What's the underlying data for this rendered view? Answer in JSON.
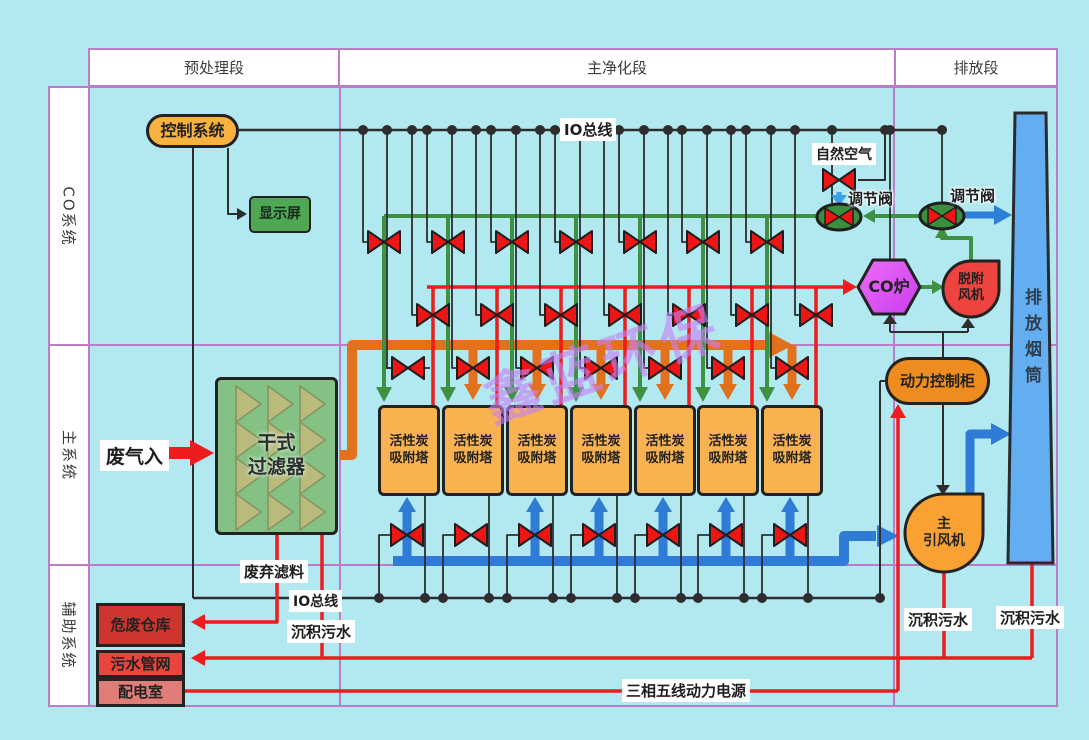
{
  "headers": {
    "pretreatment": "预处理段",
    "main_purification": "主净化段",
    "emission": "排放段"
  },
  "row_labels": {
    "co_system": "CO系统",
    "main_system": "主系统",
    "aux_system": "辅助系统"
  },
  "nodes": {
    "control_system": "控制系统",
    "display_screen": "显示屏",
    "dry_filter_line1": "干式",
    "dry_filter_line2": "过滤器",
    "tower_line1": "活性炭",
    "tower_line2": "吸附塔",
    "tower_count": 7,
    "co_furnace": "CO炉",
    "desorption_fan_line1": "脱附",
    "desorption_fan_line2": "风机",
    "power_cabinet": "动力控制柜",
    "main_fan_line1": "主",
    "main_fan_line2": "引风机",
    "stack": "排放烟筒",
    "hazardous_waste_warehouse": "危废仓库",
    "sewage_pipe_network": "污水管网",
    "power_distribution_room": "配电室"
  },
  "labels": {
    "io_bus_top": "IO总线",
    "io_bus_bottom": "IO总线",
    "natural_air": "自然空气",
    "regulating_valve_left": "调节阀",
    "regulating_valve_right": "调节阀",
    "waste_gas_in": "废气入",
    "waste_filter_material": "废弃滤料",
    "sediment_sewage_left": "沉积污水",
    "sediment_sewage_mid": "沉积污水",
    "sediment_sewage_right": "沉积污水",
    "power_supply_line": "三相五线动力电源",
    "watermark": "鑫蓝环保"
  },
  "colors": {
    "background": "#b2e8f0",
    "grid_purple": "#bd7cc8",
    "pipe_orange": "#e2711d",
    "pipe_blue": "#2e7cd6",
    "arrow_blue_light": "#3da0e8",
    "line_green": "#3e9142",
    "line_red": "#ee1c1c",
    "line_black": "#2d2d2d",
    "node_orange": "#f9b13f",
    "cabinet_orange": "#ef8c1f",
    "display_green": "#4fa653",
    "filter_green": "#85c185",
    "tower_orange": "#f8b24f",
    "furnace_magenta": "#d94fef",
    "fan_red": "#ef4340",
    "fan_orange": "#f9a233",
    "stack_blue": "#63aef0",
    "warehouse_red": "#cd3630",
    "sewage_red": "#ea453c",
    "powerroom_red": "#e07d78",
    "valve_red": "#ee1515",
    "regvalve_green": "#3a8f3e"
  }
}
